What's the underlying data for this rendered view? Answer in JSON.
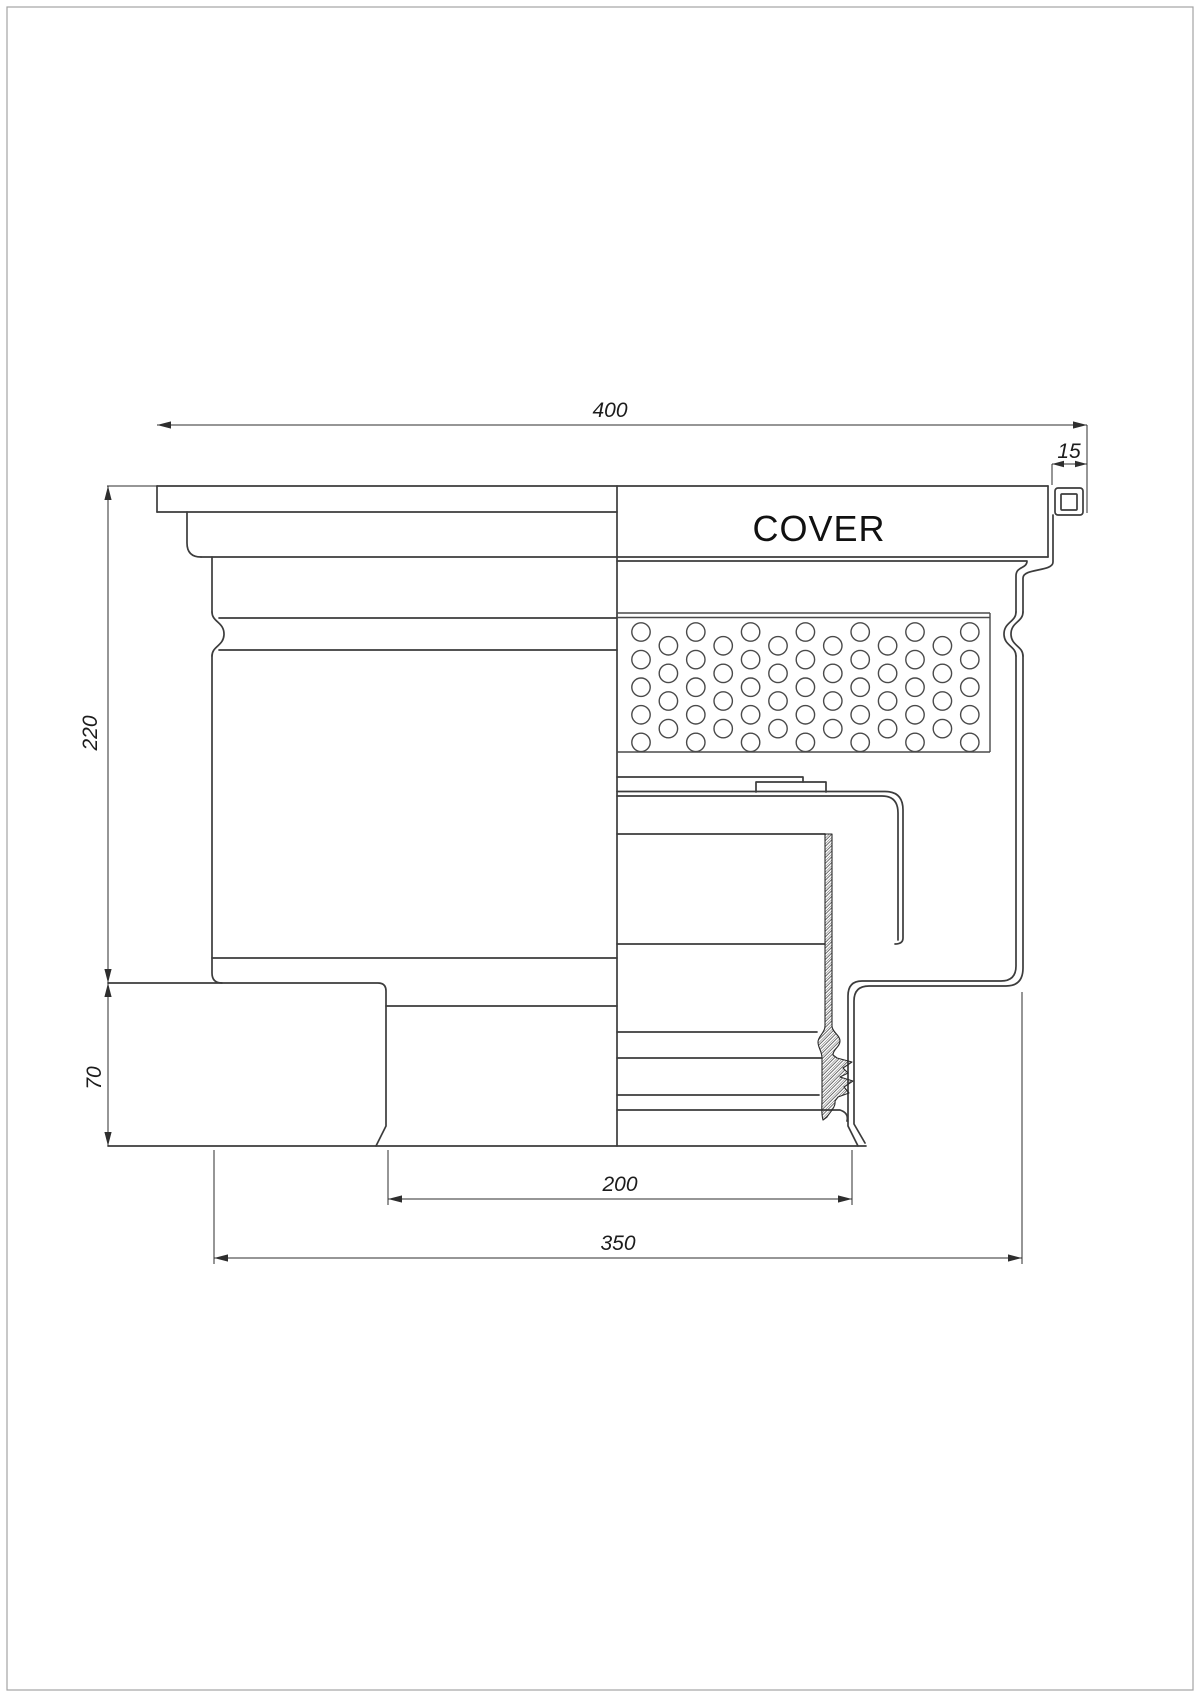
{
  "drawing": {
    "cover_label": "COVER",
    "dimensions": {
      "top_width": "400",
      "clamp_width": "15",
      "upper_height": "220",
      "lower_height": "70",
      "outlet_width": "200",
      "base_width": "350"
    }
  },
  "colors": {
    "line_main": "#3c3c3c",
    "line_dim": "#2e2e2e",
    "page_border": "#a3a3a3",
    "background": "#ffffff"
  }
}
